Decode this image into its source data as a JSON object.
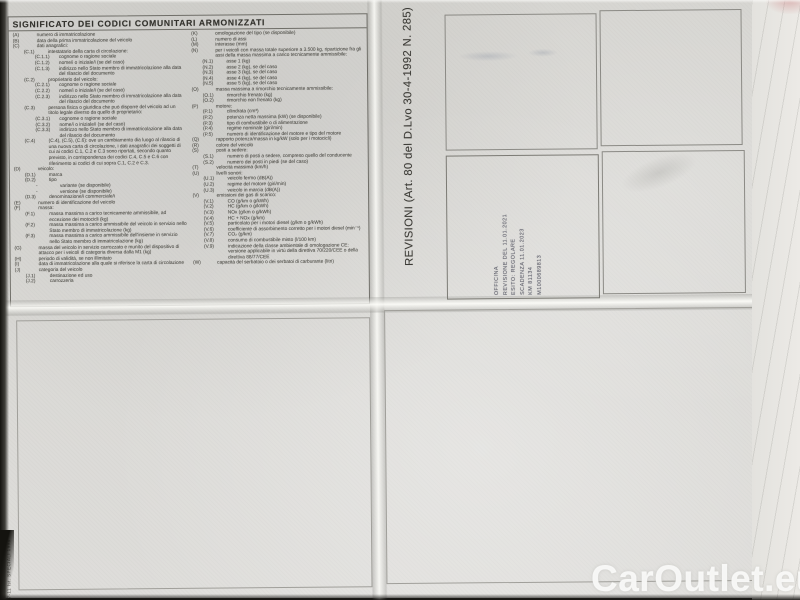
{
  "legend": {
    "title": "SIGNIFICATO DEI CODICI COMUNITARI ARMONIZZATI",
    "codes_left": [
      {
        "code": "(A)",
        "text": "numero di immatricolazione",
        "indent": 0
      },
      {
        "code": "(B)",
        "text": "data della prima immatricolazione del veicolo",
        "indent": 0
      },
      {
        "code": "(C)",
        "text": "dati anagrafici:",
        "indent": 0
      },
      {
        "code": "(C.1)",
        "text": "intestatario della carta di circolazione:",
        "indent": 1
      },
      {
        "code": "(C.1.1)",
        "text": "cognome o ragione sociale",
        "indent": 2
      },
      {
        "code": "(C.1.2)",
        "text": "nome/i o iniziale/i (se del caso)",
        "indent": 2
      },
      {
        "code": "(C.1.3)",
        "text": "indirizzo nello Stato membro di immatricolazione alla data del rilascio del documento",
        "indent": 2
      },
      {
        "code": "(C.2)",
        "text": "proprietario del veicolo:",
        "indent": 1
      },
      {
        "code": "(C.2.1)",
        "text": "cognome o ragione sociale",
        "indent": 2
      },
      {
        "code": "(C.2.2)",
        "text": "nome/i o iniziale/i (se del caso)",
        "indent": 2
      },
      {
        "code": "(C.2.3)",
        "text": "indirizzo nello Stato membro di immatricolazione alla data del rilascio del documento",
        "indent": 2
      },
      {
        "code": "(C.3)",
        "text": "persona fisica o giuridica che può disporre del veicolo ad un titolo legale diverso da quello di proprietario:",
        "indent": 1
      },
      {
        "code": "(C.3.1)",
        "text": "cognome o ragione sociale",
        "indent": 2
      },
      {
        "code": "(C.3.2)",
        "text": "nome/i o iniziale/i (se del caso)",
        "indent": 2
      },
      {
        "code": "(C.3.3)",
        "text": "indirizzo nello Stato membro di immatricolazione alla data del rilascio del documento",
        "indent": 2
      },
      {
        "code": "(C.4)",
        "text": "(C.4), (C.5), (C.6): ove un cambiamento dia luogo al rilascio di una nuova carta di circolazione, i dati anagrafici dei soggetti di cui ai codici C.1, C.2 e C.3 sono riportati, secondo quanto previsto, in corrispondenza dei codici C.4, C.5 e C.6 con riferimento ai codici di cui sopra C.1, C.2 e C.3.",
        "indent": 1
      },
      {
        "code": "(D)",
        "text": "veicolo:",
        "indent": 0
      },
      {
        "code": "(D.1)",
        "text": "marca",
        "indent": 1
      },
      {
        "code": "(D.2)",
        "text": "tipo",
        "indent": 1
      },
      {
        "code": "-",
        "text": "variante (se disponibile)",
        "indent": 2
      },
      {
        "code": "-",
        "text": "versione (se disponibile)",
        "indent": 2
      },
      {
        "code": "(D.3)",
        "text": "denominazione/i commerciale/i",
        "indent": 1
      },
      {
        "code": "(E)",
        "text": "numero di identificazione del veicolo",
        "indent": 0
      },
      {
        "code": "(F)",
        "text": "massa:",
        "indent": 0
      },
      {
        "code": "(F.1)",
        "text": "massa massima a carico tecnicamente ammissibile, ad eccezione dei motocicli (kg)",
        "indent": 1
      },
      {
        "code": "(F.2)",
        "text": "massa massima a carico ammissibile del veicolo in servizio nello Stato membro di immatricolazione (kg)",
        "indent": 1
      },
      {
        "code": "(F.3)",
        "text": "massa massima a carico ammissibile dell'insieme in servizio nello Stato membro di immatricolazione (kg)",
        "indent": 1
      },
      {
        "code": "(G)",
        "text": "massa del veicolo in servizio carrozzato e munito del dispositivo di attacco per i veicoli di categoria diversa dalla M1 (kg)",
        "indent": 0
      },
      {
        "code": "(H)",
        "text": "periodo di validità, se non illimitato",
        "indent": 0
      },
      {
        "code": "(I)",
        "text": "data di immatricolazione alla quale si riferisce la carta di circolazione",
        "indent": 0
      },
      {
        "code": "(J)",
        "text": "categoria del veicolo",
        "indent": 0
      },
      {
        "code": "(J.1)",
        "text": "destinazione ed uso",
        "indent": 1
      },
      {
        "code": "(J.2)",
        "text": "carrozzeria",
        "indent": 1
      }
    ],
    "codes_right": [
      {
        "code": "(K)",
        "text": "omologazione del tipo (se disponibile)",
        "indent": 0
      },
      {
        "code": "(L)",
        "text": "numero di assi",
        "indent": 0
      },
      {
        "code": "(M)",
        "text": "interasse (mm)",
        "indent": 0
      },
      {
        "code": "(N)",
        "text": "per i veicoli con massa totale superiore a 3.500 kg, ripartizione fra gli assi della massa massima a carico tecnicamente ammissibile:",
        "indent": 0
      },
      {
        "code": "(N.1)",
        "text": "asse 1 (kg)",
        "indent": 1
      },
      {
        "code": "(N.2)",
        "text": "asse 2 (kg), se del caso",
        "indent": 1
      },
      {
        "code": "(N.3)",
        "text": "asse 3 (kg), se del caso",
        "indent": 1
      },
      {
        "code": "(N.4)",
        "text": "asse 4 (kg), se del caso",
        "indent": 1
      },
      {
        "code": "(N.5)",
        "text": "asse 5 (kg), se del caso",
        "indent": 1
      },
      {
        "code": "(O)",
        "text": "massa massima a rimorchio tecnicamente ammissibile:",
        "indent": 0
      },
      {
        "code": "(O.1)",
        "text": "rimorchio frenato (kg)",
        "indent": 1
      },
      {
        "code": "(O.2)",
        "text": "rimorchio non frenato (kg)",
        "indent": 1
      },
      {
        "code": "(P)",
        "text": "motore:",
        "indent": 0
      },
      {
        "code": "(P.1)",
        "text": "cilindrata (cm³)",
        "indent": 1
      },
      {
        "code": "(P.2)",
        "text": "potenza netta massima (kW) (se disponibile)",
        "indent": 1
      },
      {
        "code": "(P.3)",
        "text": "tipo di combustibile o di alimentazione",
        "indent": 1
      },
      {
        "code": "(P.4)",
        "text": "regime nominale (giri/min)",
        "indent": 1
      },
      {
        "code": "(P.5)",
        "text": "numero di identificazione del motore e tipo del motore",
        "indent": 1
      },
      {
        "code": "(Q)",
        "text": "rapporto potenza/massa in kg/kW (solo per i motocicli)",
        "indent": 0
      },
      {
        "code": "(R)",
        "text": "colore del veicolo",
        "indent": 0
      },
      {
        "code": "(S)",
        "text": "posti a sedere:",
        "indent": 0
      },
      {
        "code": "(S.1)",
        "text": "numero di posti a sedere, compreso quello del conducente",
        "indent": 1
      },
      {
        "code": "(S.2)",
        "text": "numero dei posti in piedi (se del caso)",
        "indent": 1
      },
      {
        "code": "(T)",
        "text": "velocità massima (km/h)",
        "indent": 0
      },
      {
        "code": "(U)",
        "text": "livelli sonori:",
        "indent": 0
      },
      {
        "code": "(U.1)",
        "text": "veicolo fermo (dB(A))",
        "indent": 1
      },
      {
        "code": "(U.2)",
        "text": "regime del motore (giri/min)",
        "indent": 1
      },
      {
        "code": "(U.3)",
        "text": "veicolo in marcia (dB(A))",
        "indent": 1
      },
      {
        "code": "(V)",
        "text": "emissioni dei gas di scarico:",
        "indent": 0
      },
      {
        "code": "(V.1)",
        "text": "CO (g/km o g/kWh)",
        "indent": 1
      },
      {
        "code": "(V.2)",
        "text": "HC (g/km o g/kWh)",
        "indent": 1
      },
      {
        "code": "(V.3)",
        "text": "NOx (g/km o g/kWh)",
        "indent": 1
      },
      {
        "code": "(V.4)",
        "text": "HC + NOx (g/km)",
        "indent": 1
      },
      {
        "code": "(V.5)",
        "text": "particolato per i motori diesel (g/km o g/kWh)",
        "indent": 1
      },
      {
        "code": "(V.6)",
        "text": "coefficiente di assorbimento corretto per i motori diesel (min⁻¹)",
        "indent": 1
      },
      {
        "code": "(V.7)",
        "text": "CO₂ (g/km)",
        "indent": 1
      },
      {
        "code": "(V.8)",
        "text": "consumo di combustibile misto (l/100 km)",
        "indent": 1
      },
      {
        "code": "(V.9)",
        "text": "indicazione della classe ambientale di omologazione CE: versione applicabile in virtù della direttiva 70/220/CEE o della direttiva 88/77/CEE",
        "indent": 1
      },
      {
        "code": "(W)",
        "text": "capacità del serbatoio o dei serbatoi di carburante (litri)",
        "indent": 0
      }
    ]
  },
  "revisions": {
    "label": "REVISIONI (Art. 80 del D.Lvo 30-4-1992 N. 285)",
    "stamp_lines": [
      "OFFICINA",
      "REVISIONE DEL 11.01.2021",
      "ESITO: REGOLARE",
      "SCADENZA 11.01.2023",
      "KM 81134",
      "M1000689813"
    ]
  },
  "margin": {
    "print_code": "17-11 Ist. SPECIALI 1998"
  },
  "watermark": {
    "text": "CarOutlet.eu"
  },
  "colors": {
    "paper": "#d7d6d2",
    "ink": "#53524c",
    "stamp_ink": "#555662",
    "watermark": "#fcfcfa"
  }
}
